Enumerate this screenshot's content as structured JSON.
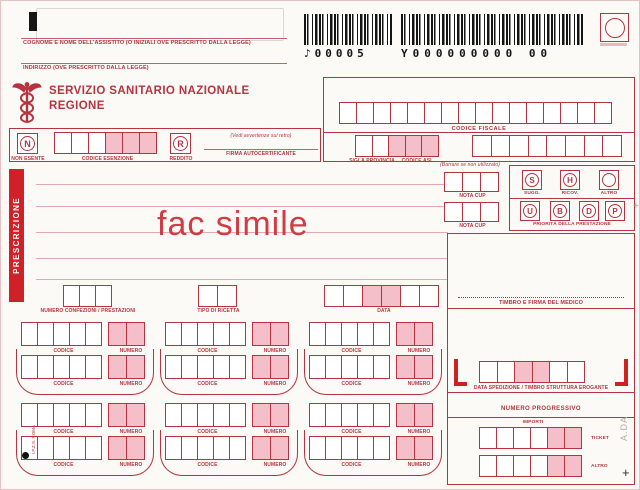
{
  "page": {
    "fac_simile": "fac simile",
    "prescrizione_label": "PRESCRIZIONE"
  },
  "patient": {
    "name_label": "COGNOME E NOME DELL'ASSISTITO (O INIZIALI OVE PRESCRITTO DALLA LEGGE)",
    "address_label": "INDIRIZZO (OVE PRESCRITTO DALLA LEGGE)"
  },
  "org": {
    "line1": "SERVIZIO SANITARIO NAZIONALE",
    "line2": "REGIONE"
  },
  "barcode": {
    "code1": "♪00005",
    "code2": "Y000000000 00"
  },
  "esenzione": {
    "non_esente_letter": "N",
    "non_esente_label": "NON ESENTE",
    "codice_esenzione_label": "CODICE ESENZIONE",
    "reddito_letter": "R",
    "reddito_label": "REDDITO",
    "avvertenze_note": "(Vedi avvertenze sul retro)",
    "firma_label": "FIRMA AUTOCERTIFICANTE"
  },
  "codice_fiscale": {
    "label": "CODICE FISCALE",
    "sigla_provincia_label": "SIGLA PROVINCIA",
    "codice_asl_label": "CODICE ASL"
  },
  "middle": {
    "numero_confezioni_label": "NUMERO CONFEZIONI / PRESTAZIONI",
    "tipo_ricetta_label": "TIPO DI RICETTA",
    "data_label": "DATA"
  },
  "groups": {
    "codice": "CODICE",
    "numero": "NUMERO"
  },
  "right": {
    "barrare_note": "(Barrare se non utilizzato)",
    "nota_cup_label": "NOTA CUP",
    "sugg_letter": "S",
    "sugg_label": "SUGG.",
    "ricov_letter": "H",
    "ricov_label": "RICOV.",
    "altro_label": "ALTRO",
    "priorita_letters": [
      "U",
      "B",
      "D",
      "P"
    ],
    "priorita_label": "PRIORITÀ DELLA PRESTAZIONE",
    "timbro_medico_label": "TIMBRO E FIRMA DEL MEDICO",
    "data_spedizione_label": "DATA SPEDIZIONE / TIMBRO STRUTTURA EROGANTE",
    "numero_progressivo_label": "NUMERO PROGRESSIVO",
    "importi_label": "IMPORTI",
    "ticket_label": "TICKET",
    "altro_importo_label": "ALTRO"
  },
  "margins": {
    "ipzs": "I.P.Z.S. ROMA",
    "ada": "A.DA",
    "plus_mark": "+"
  },
  "colors": {
    "accent_red": "#b5343f",
    "bright_red": "#d02129",
    "pink_fill": "#f5bfc9",
    "barcode_ink": "#141414"
  }
}
